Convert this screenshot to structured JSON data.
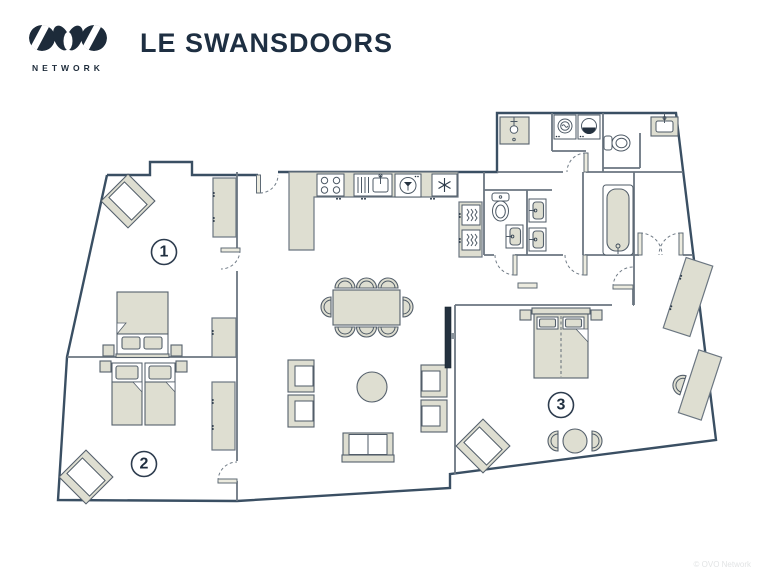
{
  "header": {
    "logo_text": "OVO",
    "logo_subtext": "NETWORK",
    "title": "LE SWANSDOORS"
  },
  "plan": {
    "rooms": [
      {
        "label": "1",
        "name": "bedroom-1"
      },
      {
        "label": "2",
        "name": "bedroom-2"
      },
      {
        "label": "3",
        "name": "bedroom-3"
      }
    ],
    "furniture_items": [
      "double-bed",
      "single-bed",
      "wardrobe",
      "armchair",
      "dining-table",
      "dining-chair",
      "sofa",
      "coffee-table",
      "tv",
      "desk",
      "desk-chair",
      "round-table",
      "bathtub",
      "shower",
      "toilet",
      "washbasin",
      "washing-machine",
      "tumble-dryer",
      "oven",
      "hob",
      "kitchen-sink",
      "dishwasher",
      "freezer"
    ],
    "icons": {
      "hob": "hob-icon",
      "kitchen_sink": "kitchen-sink-icon",
      "dishwasher": "dishwasher-icon",
      "freezer": "freezer-icon",
      "oven": "oven-icon",
      "washing_machine": "washing-machine-icon",
      "tumble_dryer": "tumble-dryer-icon",
      "shower": "shower-icon",
      "toilet": "toilet-icon",
      "bathtub": "bathtub-icon",
      "washbasin": "washbasin-icon",
      "tv": "tv-icon"
    }
  },
  "colors": {
    "wall_exterior": "#3a4f63",
    "wall_interior": "#6b7681",
    "furniture_fill": "#deded1",
    "brand_navy": "#1d2b3a"
  },
  "watermark": "© OVO Network"
}
